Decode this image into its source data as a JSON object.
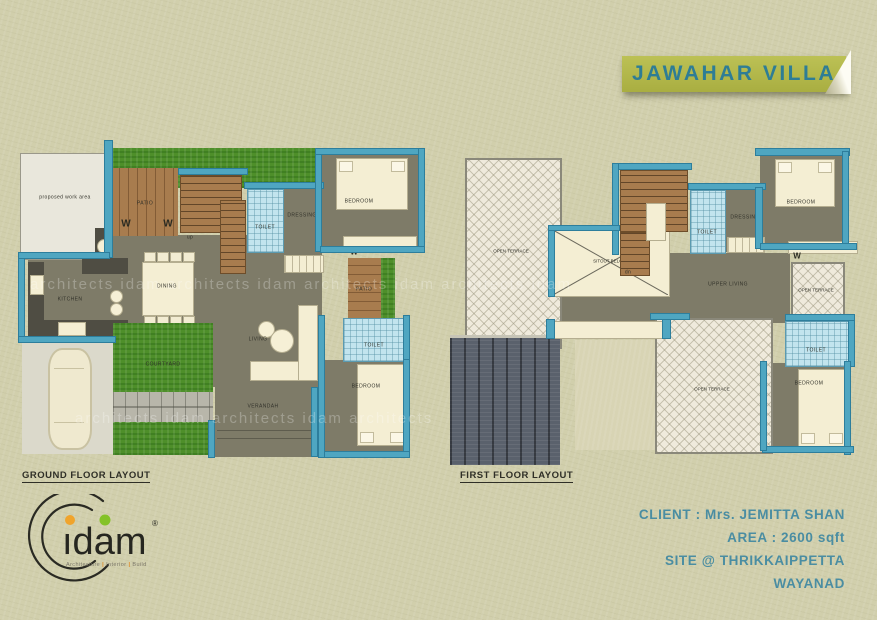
{
  "banner": {
    "title": "JAWAHAR VILLA"
  },
  "ground_floor": {
    "caption": "GROUND FLOOR LAYOUT",
    "labels": {
      "work_area": "proposed work area",
      "patio_top": "PATIO",
      "up": "up",
      "toilet_top": "TOILET",
      "dressing": "DRESSING",
      "bedroom_top": "BEDROOM",
      "kitchen": "KITCHEN",
      "dining": "DINING",
      "living": "LIVING",
      "courtyard": "COURTYARD",
      "verandah": "VERANDAH",
      "patio_side": "PATIO",
      "toilet_side": "TOILET",
      "bedroom_bottom": "BEDROOM",
      "tree": "W"
    }
  },
  "first_floor": {
    "caption": "FIRST FLOOR LAYOUT",
    "labels": {
      "open_terrace_left": "OPEN TERRACE",
      "sitout_below": "SITOUT BELOW",
      "dn": "dn",
      "toilet_top": "TOILET",
      "dressing": "DRESSING",
      "bedroom_top": "BEDROOM",
      "upper_living": "UPPER LIVING",
      "open_terrace_small": "OPEN TERRACE",
      "toilet_side": "TOILET",
      "bedroom_bottom": "BEDROOM",
      "open_terrace_big": "OPEN TERRACE",
      "tree": "W"
    }
  },
  "project_info": {
    "client": "CLIENT : Mrs. JEMITTA SHAN",
    "area": "AREA : 2600 sqft",
    "site": "SITE @ THRIKKAIPPETTA",
    "district": "WAYANAD"
  },
  "logo": {
    "name": "idam",
    "name_display": "ıdam",
    "registered": "®",
    "tagline_parts": [
      "Architecture",
      "Interior",
      "Build"
    ],
    "separator": "|"
  },
  "watermark": "architects  idam  architects  idam  architects  idam  architects  idam",
  "colors": {
    "banner_bg": "#b4b94b",
    "banner_text": "#2e7d95",
    "wall": "#4fa6c1",
    "floor": "#7e7b68",
    "grass": "#4e8f2a",
    "wood": "#a87c4e",
    "tile": "#c2e4ee",
    "info_text": "#4a8da2"
  }
}
